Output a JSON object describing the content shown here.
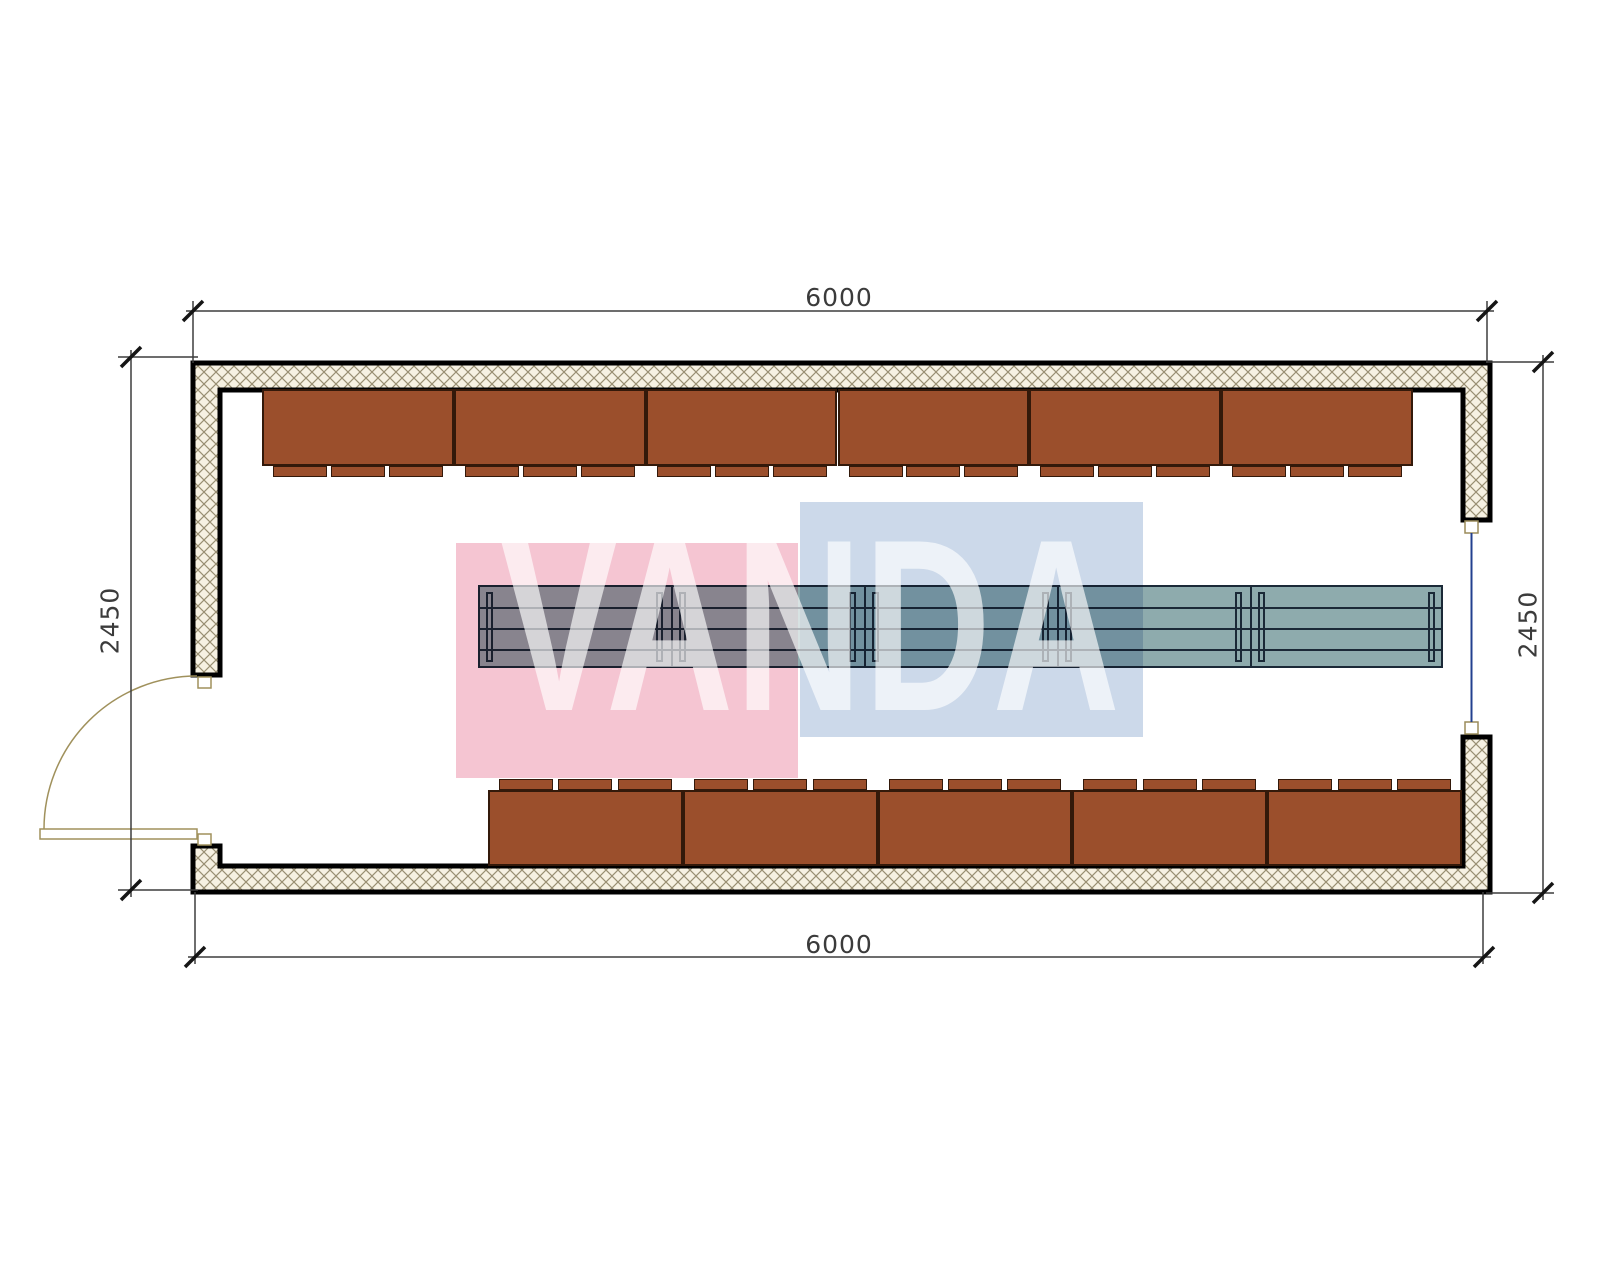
{
  "drawing": {
    "type": "floor-plan",
    "dimensions": {
      "top": "6000",
      "bottom": "6000",
      "left": "2450",
      "right": "2450"
    },
    "watermark": {
      "text": "VANDA",
      "pink": "#f5c5d2",
      "blue": "#ccd9ea",
      "text_color": "rgba(255,255,255,0.65)"
    },
    "walls": {
      "fill": "#f6f1e2",
      "hatch_color": "#998f72",
      "outline": "#000000"
    },
    "door": {
      "position": "left-bottom",
      "swing": "outward",
      "color": "#a0915c"
    },
    "window": {
      "position": "right",
      "color": "#23408f"
    },
    "benches": {
      "fill": "#9b4f2c",
      "outline": "#33190a",
      "top_row": {
        "count": 6,
        "tabs_per_bench": 3
      },
      "bottom_row": {
        "count": 5,
        "tabs_per_bench": 3
      }
    },
    "table": {
      "fill": "#8eabad",
      "outline": "#1b2937",
      "modules": 5,
      "legs_per_module": 2
    }
  }
}
